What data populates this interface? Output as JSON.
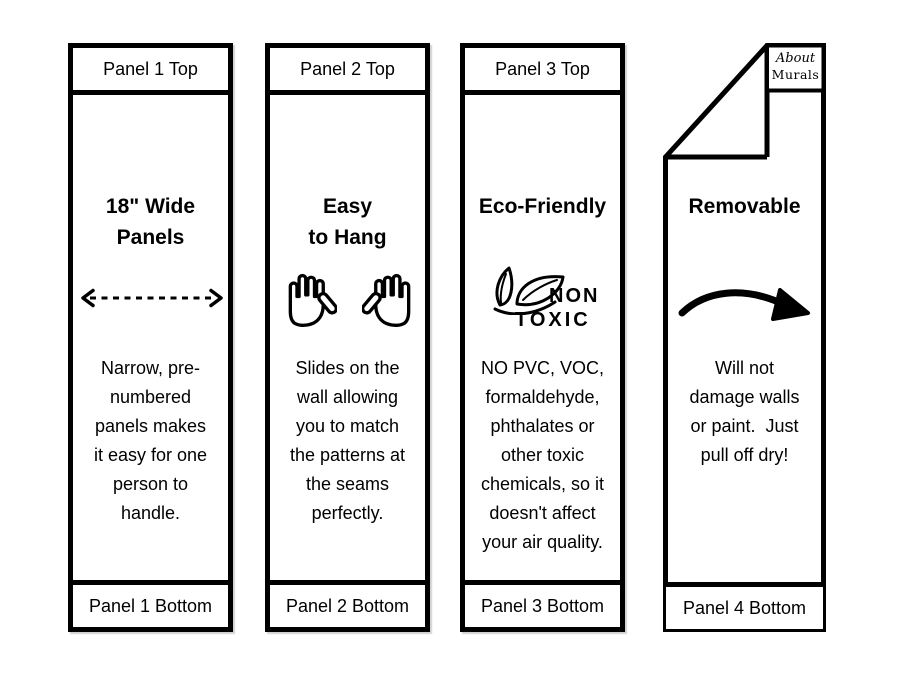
{
  "page": {
    "background": "#ffffff",
    "ink": "#000000"
  },
  "icons": {
    "panel1": "double-headed-dashed-arrow",
    "panel2": "raised-hands",
    "panel3": "non-toxic-leaves",
    "panel4": "curved-arrow",
    "panel4_corner": "folded-corner"
  },
  "panels": [
    {
      "header": "Panel 1 Top",
      "title": "18\" Wide\nPanels",
      "body": "Narrow, pre-\nnumbered\npanels makes\nit easy for one\nperson to\nhandle.",
      "footer": "Panel 1 Bottom"
    },
    {
      "header": "Panel 2 Top",
      "title": "Easy\nto Hang",
      "body": "Slides on the\nwall allowing\nyou to match\nthe patterns at\nthe seams\nperfectly.",
      "footer": "Panel 2 Bottom"
    },
    {
      "header": "Panel 3 Top",
      "title": "Eco-Friendly",
      "non_toxic": {
        "line1": "NON",
        "line2": "TOXIC"
      },
      "body": "NO PVC, VOC,\nformaldehyde,\nphthalates or\nother toxic\nchemicals, so it\ndoesn't affect\nyour air quality.",
      "footer": "Panel 3 Bottom"
    },
    {
      "title": "Removable",
      "logo": {
        "line1": "About",
        "line2": "Murals"
      },
      "body": "Will not\ndamage walls\nor paint.  Just\npull off dry!",
      "footer": "Panel 4 Bottom"
    }
  ]
}
